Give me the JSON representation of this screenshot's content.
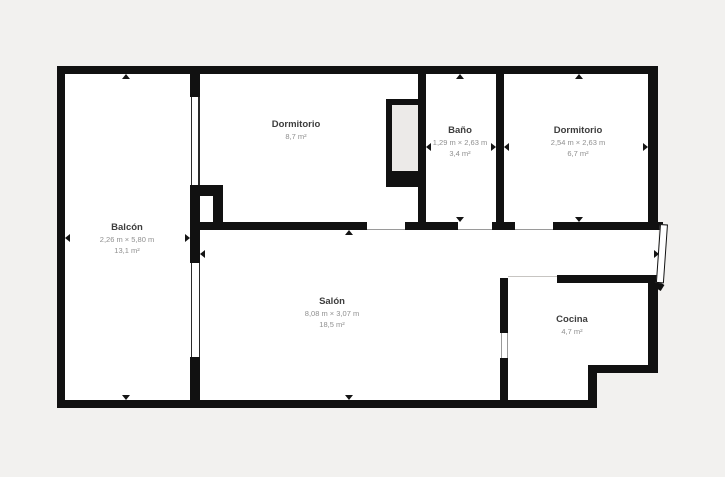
{
  "plan_title": "Floor plan",
  "colors": {
    "wall": "#111111",
    "background": "#f2f1ef",
    "interior": "#ffffff",
    "label_text": "#3d3d3d",
    "sublabel_text": "#8f8f8f"
  },
  "rooms": [
    {
      "id": "balcon",
      "name": "Balcón",
      "dims": "2,26 m × 5,80 m",
      "area": "13,1 m²"
    },
    {
      "id": "dormitorio-1",
      "name": "Dormitorio",
      "area": "8,7 m²"
    },
    {
      "id": "bano",
      "name": "Baño",
      "dims": "1,29 m × 2,63 m",
      "area": "3,4 m²"
    },
    {
      "id": "dormitorio-2",
      "name": "Dormitorio",
      "dims": "2,54 m × 2,63 m",
      "area": "6,7 m²"
    },
    {
      "id": "salon",
      "name": "Salón",
      "dims": "8,08 m × 3,07 m",
      "area": "18,5 m²"
    },
    {
      "id": "cocina",
      "name": "Cocina",
      "area": "4,7 m²"
    }
  ]
}
